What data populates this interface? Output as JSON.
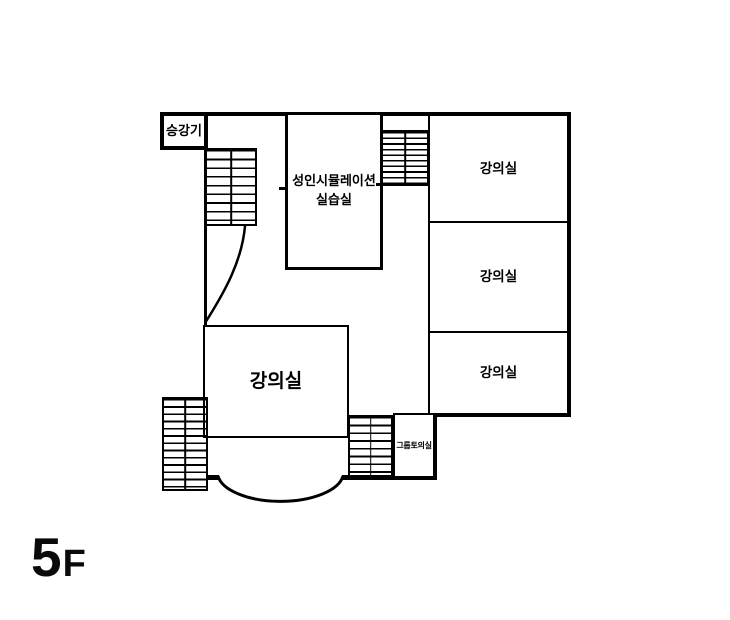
{
  "floor": {
    "number": "5",
    "suffix": "F"
  },
  "colors": {
    "background": "#ffffff",
    "wall": "#000000"
  },
  "rooms": {
    "elevator": {
      "label": "승강기"
    },
    "simulation": {
      "line1": "성인시뮬레이션",
      "line2": "실습실"
    },
    "lecture_right_top": {
      "label": "강의실"
    },
    "lecture_right_middle": {
      "label": "강의실"
    },
    "lecture_right_bottom": {
      "label": "강의실"
    },
    "lecture_main": {
      "label": "강의실"
    },
    "group_discussion": {
      "label": "그룹토의실"
    }
  }
}
